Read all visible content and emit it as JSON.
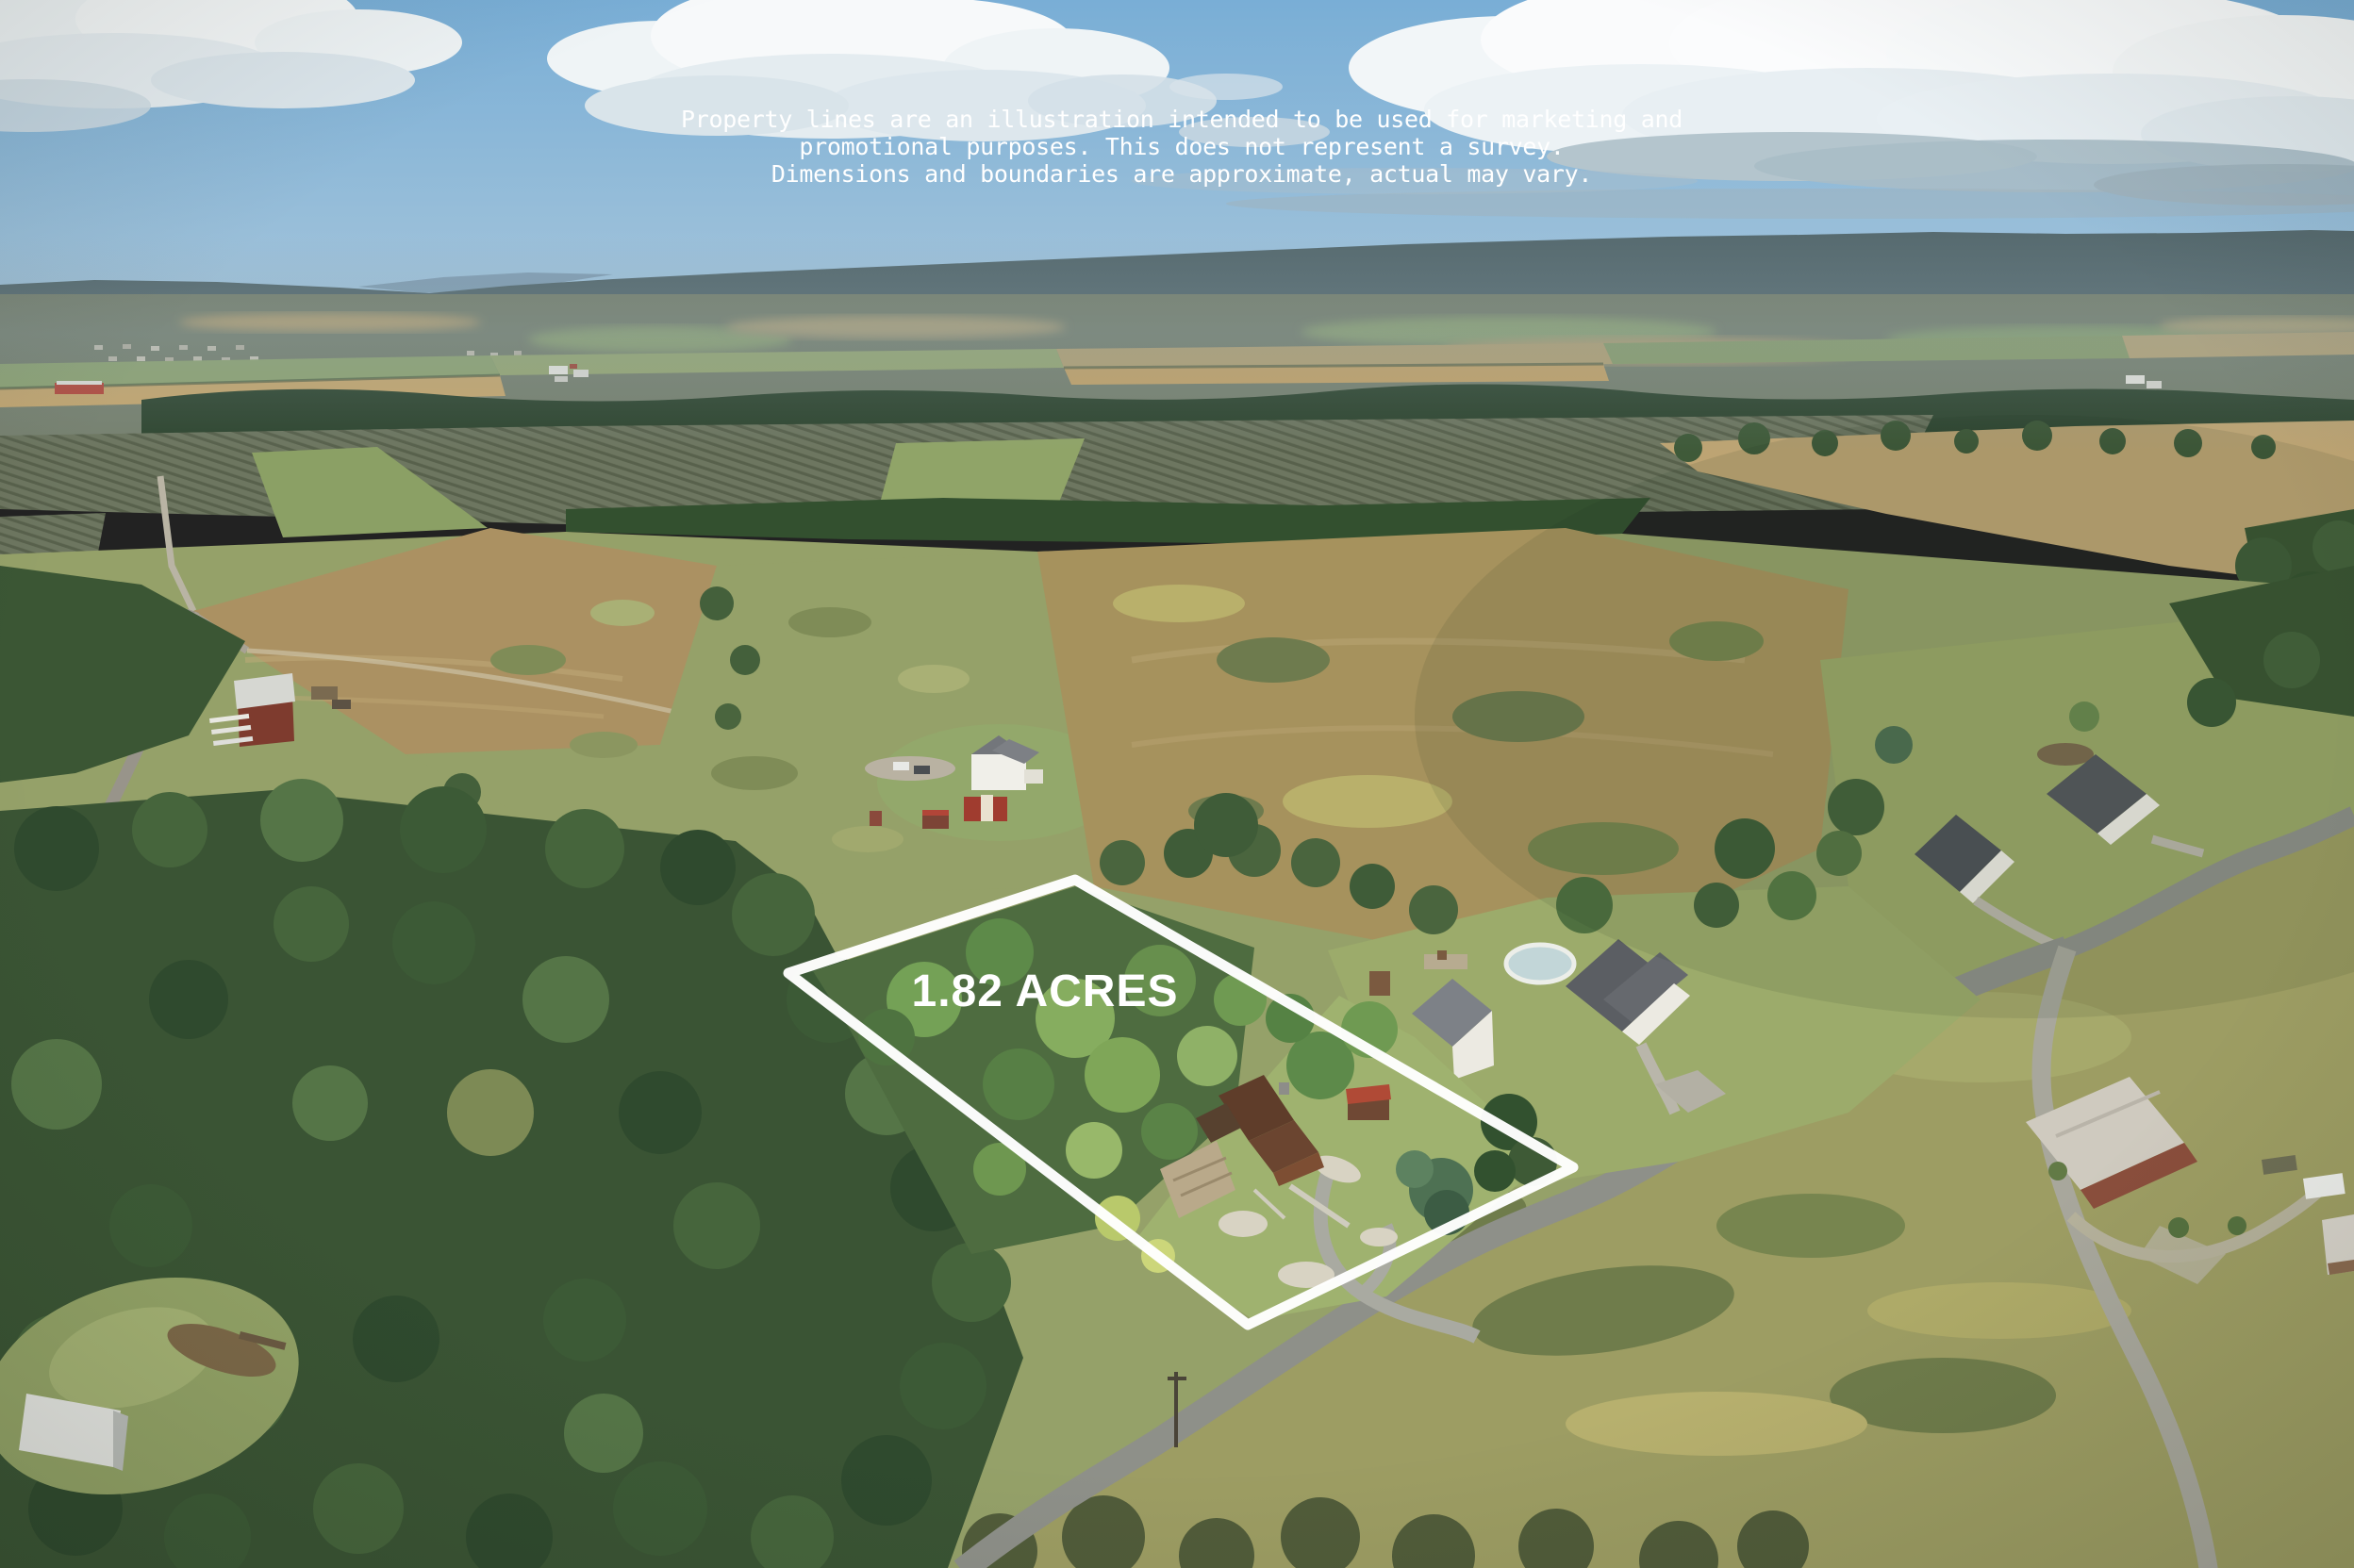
{
  "photo": {
    "description": "Aerial drone photograph of a rural 1.82 acre property outlined in white, with farmland, woods, houses and country roads",
    "acreage_label": "1.82 ACRES"
  },
  "disclaimer": {
    "line1": "Property lines are an illustration intended to be used for marketing and",
    "line2": "promotional purposes. This does not represent a survey.",
    "line3": "Dimensions and boundaries are approximate, actual may vary."
  },
  "lot": {
    "boundary_points": "1140,933 1668,1238 1323,1405 836,1032"
  },
  "palette": {
    "boundary_line": "#ffffff",
    "text_white": "#ffffff",
    "sky_top": "#79aed6",
    "sky_horizon": "#a9c7db",
    "cloud_white": "#f7f9fa",
    "cloud_shadow": "#a9bcc6",
    "mountain": "#576b70",
    "valley_haze": "#77816f",
    "forest_dark": "#2f4630",
    "field_tan": "#b99c6d",
    "field_gold": "#c6a76e",
    "orchard_gray": "#6d7660",
    "scrub_green": "#95a169",
    "lawn_green": "#9aa768",
    "meadow_olive": "#9d9d63",
    "road_gray": "#8e9089",
    "subject_woods": "#4e6c40",
    "cabin_brown": "#7d4e33",
    "shed_roof_red": "#b04a36",
    "house_white": "#eceae2"
  }
}
